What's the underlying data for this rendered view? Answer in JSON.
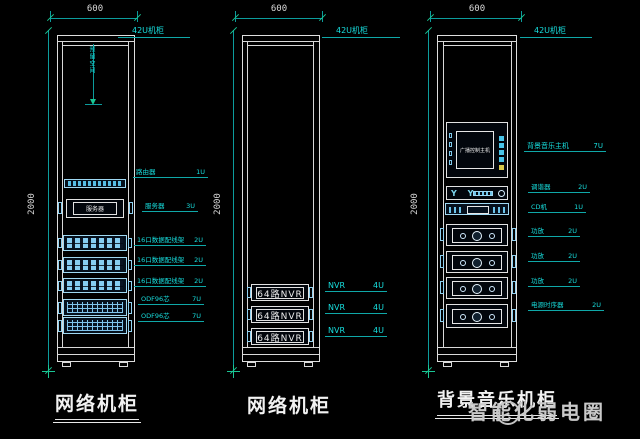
{
  "icons": {
    "antenna": "Y Y"
  },
  "watermark": {
    "text": "智能化弱电圈"
  },
  "cabinets": [
    {
      "width_dim": "600",
      "height_dim": "2000",
      "type_label": "42U机柜",
      "note_vertical": "预留空间",
      "caption": "网络机柜",
      "devices": {
        "server_label": "服务器"
      },
      "annotations": [
        {
          "label": "路由器",
          "u": "1U"
        },
        {
          "label": "服务器",
          "u": "3U"
        },
        {
          "label": "16口数据配线架",
          "u": "2U"
        },
        {
          "label": "16口数据配线架",
          "u": "2U"
        },
        {
          "label": "16口数据配线架",
          "u": "2U"
        },
        {
          "label": "ODF96芯",
          "u": "7U"
        },
        {
          "label": "ODF96芯",
          "u": "7U"
        }
      ]
    },
    {
      "width_dim": "600",
      "height_dim": "2000",
      "type_label": "42U机柜",
      "caption": "网络机柜",
      "devices": {
        "nvr_label": "64路NVR"
      },
      "annotations": [
        {
          "label": "NVR",
          "u": "4U"
        },
        {
          "label": "NVR",
          "u": "4U"
        },
        {
          "label": "NVR",
          "u": "4U"
        }
      ]
    },
    {
      "width_dim": "600",
      "height_dim": "2000",
      "type_label": "42U机柜",
      "caption": "背景音乐机柜",
      "devices": {
        "host_label": "广播控制主机"
      },
      "annotations": [
        {
          "label": "背景音乐主机",
          "u": "7U"
        },
        {
          "label": "调谐器",
          "u": "2U"
        },
        {
          "label": "CD机",
          "u": "1U"
        },
        {
          "label": "功放",
          "u": "2U"
        },
        {
          "label": "功放",
          "u": "2U"
        },
        {
          "label": "功放",
          "u": "2U"
        },
        {
          "label": "电源时序器",
          "u": "2U"
        }
      ]
    }
  ],
  "colors": {
    "annotation": "#17dede",
    "dimension": "#0c9c9c",
    "device_line": "#9fd8f2",
    "structure": "#dedede"
  }
}
